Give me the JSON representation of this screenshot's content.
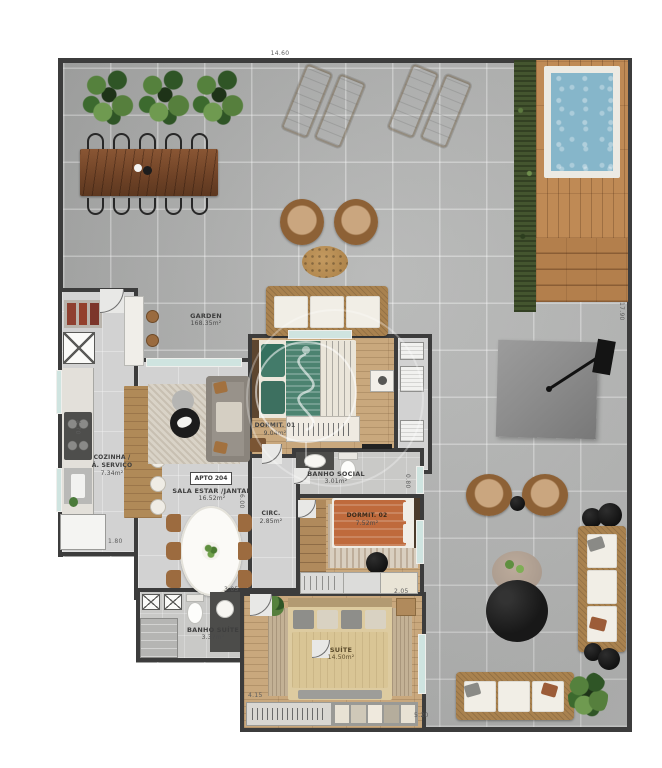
{
  "rooms": {
    "garden": {
      "name": "GARDEN",
      "area": "168.35m²"
    },
    "cozinha": {
      "name_line1": "COZINHA /",
      "name_line2": "Á. SERVIÇO",
      "area": "7.34m²"
    },
    "apto": {
      "name": "APTO 204"
    },
    "sala": {
      "name": "SALA ESTAR /JANTAR",
      "area": "16.52m²"
    },
    "dormit1": {
      "name": "DORMIT. 01",
      "area": "9.04m²"
    },
    "banho_social": {
      "name": "BANHO SOCIAL",
      "area": "3.01m²"
    },
    "circ": {
      "name": "CIRC.",
      "area": "2.85m²"
    },
    "dormit2": {
      "name": "DORMIT. 02",
      "area": "7.52m²"
    },
    "banho_suite": {
      "name": "BANHO SUÍTE",
      "area": "3.37m²"
    },
    "suite": {
      "name": "SUÍTE",
      "area": "14.50m²"
    }
  },
  "dimensions": {
    "top": "14.60",
    "right": "17.90",
    "kitchen_height": "4.70",
    "kitchen_width": "1.80",
    "sala_height": "6.00",
    "suite_top": "3.05",
    "suite_left": "4.15",
    "suite_bottom": "5.20",
    "banho_window": "0.80",
    "dormit2_corner": "2.05"
  },
  "colors": {
    "wall": "#3c3c3c",
    "tile": "#b2b3b2",
    "floor": "#d2d2d2",
    "wood": "#c9a87d",
    "deck": "#bf8a55",
    "pool": "#86b6ca",
    "hedge": "#44552f",
    "wicker": "#a9824f",
    "cushion": "#f1eee6",
    "bed_green": "#3f7a66",
    "bed_rust": "#bf6a3c",
    "bed_beige": "#d9c595",
    "umbrella": "#8d8d8d",
    "glass": "#cfe4e0"
  }
}
